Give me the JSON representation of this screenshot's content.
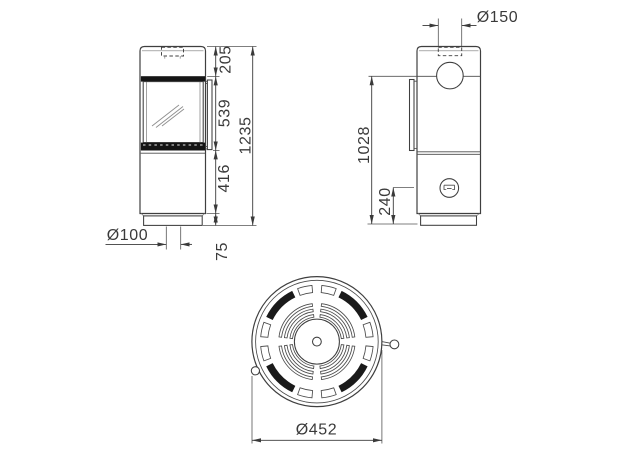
{
  "drawing": {
    "views": {
      "front": {
        "labels": {
          "top_section_height": "205",
          "door_height": "539",
          "lower_section_height": "416",
          "plinth_height": "75",
          "total_height": "1235",
          "floor_inlet_diameter": "Ø100"
        }
      },
      "side": {
        "labels": {
          "flue_collar_diameter": "Ø150",
          "flue_outlet_center_height": "1028",
          "rear_inlet_center_height": "240"
        }
      },
      "top": {
        "labels": {
          "body_diameter": "Ø452"
        }
      }
    },
    "colors": {
      "line": "#3f3f3f",
      "dark_fill": "#151515",
      "text": "#3a3a3a",
      "background": "#ffffff"
    }
  }
}
